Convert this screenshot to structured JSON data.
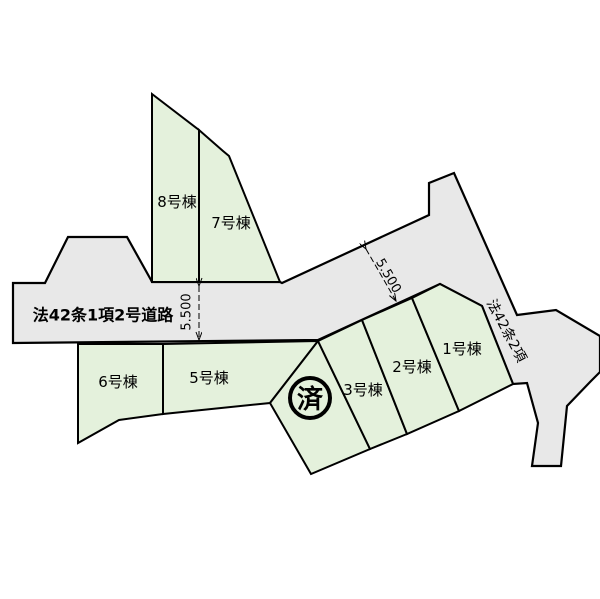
{
  "diagram": {
    "type": "land-plot-map",
    "background_color": "#ffffff",
    "lot_fill_color": "#e4f1dc",
    "road_fill_color": "#e8e8e8",
    "line_color": "#000000"
  },
  "roads": {
    "main_label": "法42条1項2号道路",
    "side_label": "法42条2項"
  },
  "dimensions": {
    "road_width_vertical": "5.500",
    "road_width_diagonal": "5.500"
  },
  "marker": {
    "sold_label": "済"
  },
  "lots": [
    {
      "id": "lot-8",
      "label": "8号棟"
    },
    {
      "id": "lot-7",
      "label": "7号棟"
    },
    {
      "id": "lot-6",
      "label": "6号棟"
    },
    {
      "id": "lot-5",
      "label": "5号棟"
    },
    {
      "id": "lot-3",
      "label": "3号棟"
    },
    {
      "id": "lot-2",
      "label": "2号棟"
    },
    {
      "id": "lot-1",
      "label": "1号棟"
    }
  ]
}
